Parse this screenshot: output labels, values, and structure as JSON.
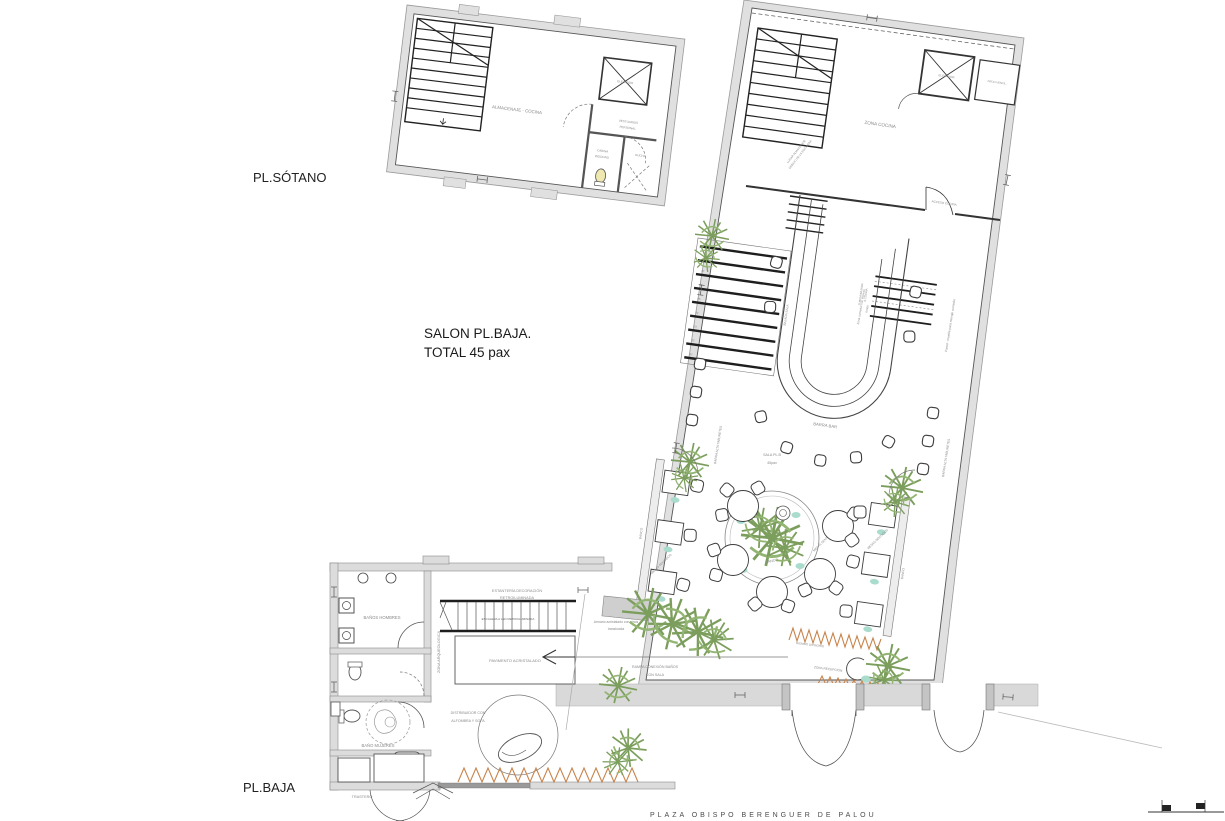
{
  "colors": {
    "wall_fill": "#e0e0e0",
    "wall_stroke": "#9a9a9a",
    "line_dark": "#3c3c3c",
    "line_mid": "#666666",
    "label_gray": "#8a8a8a",
    "plant_green": "#7c9e5d",
    "teal_accent": "#aadcce",
    "orange_accent": "#c8834a"
  },
  "titles": {
    "sotano": "PL.SÓTANO",
    "salon1": "SALON PL.BAJA.",
    "salon2": "TOTAL 45 pax",
    "baja": "PL.BAJA",
    "street": "PLAZA OBISPO BERENGUER DE PALOU"
  },
  "sotano": {
    "almacenaje": "ALMACENAJE - COCINA",
    "elevador": "ELEVADOR",
    "vestuarios1": "VESTUARIOS",
    "vestuarios2": "PERSONAL",
    "cabina1": "CABINA",
    "cabina2": "INODORO",
    "ducha": "DUCHA"
  },
  "cocina": {
    "zona": "ZONA COCINA",
    "elevador": "ELEVADOR",
    "patio": "PATIO VENTIL.",
    "almacenaje1": "LUGAR ALMACENAJE",
    "almacenaje2": "DEBAJO DE LA ESCALERA",
    "acceso": "ACCESO COCINA"
  },
  "sala": {
    "barra_bar": "BARRA BAR",
    "sala_name": "SALA PL.B",
    "sala_pax": "45pax",
    "barra_alta_left": "BARRA ALTA TABURETES",
    "barra_alta_right": "BARRA ALTA TABURETES",
    "comedor1": "Zona comedor con ingreso",
    "comedor2": "fondo",
    "pared": "Pared - mueble para menaje comedor",
    "bajada": "BAJADA SALA",
    "subida1": "SUBIDA/BAJADA",
    "subida2": "A COCINA",
    "banco_left": "BANCO",
    "banco_center": "BANCO",
    "banco_right": "BANCO",
    "mesas_left": "MESAS SENTADOS",
    "mesas_center": "MESAS SENTADOS",
    "mesas_right": "MESAS SENTADOS",
    "biombo": "BIOMBO DIVISORIO",
    "recepcion": "ZONA RECEPCIÓN",
    "steps": [
      "01",
      "02",
      "03",
      "04",
      "05",
      "06",
      "07",
      "08"
    ]
  },
  "baja": {
    "banos_hombres": "BAÑOS HOMBRES",
    "bano_mujeres": "BAÑO MUJERES",
    "estanteria1": "ESTANTERÍA DECORACIÓN",
    "estanteria2": "RETROILUMINADA",
    "escalera": "ESCALERA A LED RETROILUMINADA",
    "arqueologica": "ZONA ARQUEOLOGICA",
    "pavimento": "PAVIMENTO ACRISTALADO",
    "distribuidor1": "DISTRIBUIDOR CON",
    "distribuidor2": "ALFOMBRA Y SOFA",
    "armario1": "Armario acristalado con vinos",
    "armario2": "translúcida",
    "rampa1": "RAMPA CONEXIÓN BAÑOS",
    "rampa2": "CON SALA",
    "trastero": "TRASTERO"
  }
}
